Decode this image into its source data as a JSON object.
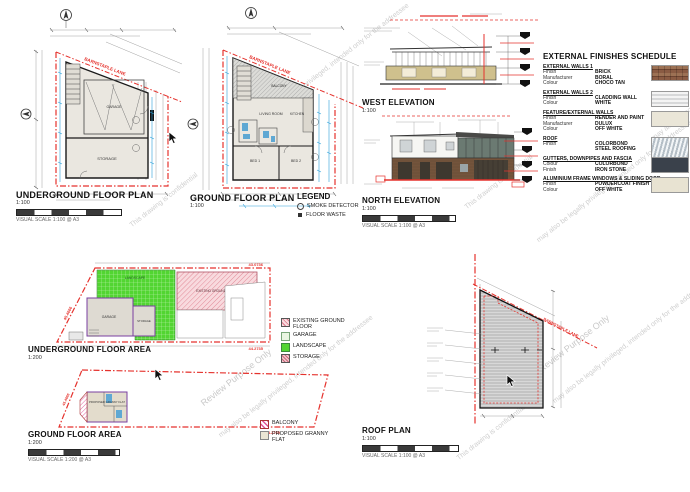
{
  "street_label": "BARNSTAPLE LANE",
  "watermarks": {
    "confidential": "This drawing is confidential",
    "review": "Review Purpose Only",
    "privileged": "may also be legally privileged, intended only for the addressee"
  },
  "plans": {
    "underground_plan": {
      "title": "UNDERGROUND FLOOR PLAN",
      "scale": "1:100",
      "scale_caption": "VISUAL SCALE 1:100 @ A3",
      "rooms": {
        "garage": "GARAGE",
        "storage": "STORAGE"
      }
    },
    "ground_plan": {
      "title": "GROUND FLOOR PLAN",
      "scale": "1:100",
      "rooms": {
        "balcony": "BALCONY",
        "living": "LIVING ROOM",
        "kitchen": "KITCHEN",
        "bed1": "BED 1",
        "bed2": "BED 2"
      }
    },
    "plan_legend": {
      "title": "LEGEND",
      "items": [
        {
          "label": "SMOKE DETECTOR"
        },
        {
          "label": "FLOOR WASTE"
        }
      ]
    },
    "west_elevation": {
      "title": "WEST ELEVATION",
      "scale": "1:100"
    },
    "north_elevation": {
      "title": "NORTH ELEVATION",
      "scale": "1:100",
      "scale_caption": "VISUAL SCALE 1:100 @ A3"
    },
    "underground_area": {
      "title": "UNDERGROUND FLOOR AREA",
      "scale": "1:200",
      "dims": {
        "top": "43.0736",
        "bottom": "44.2735",
        "side": "45.4666"
      },
      "labels": {
        "landscape": "LANDSCAPE",
        "garage": "GARAGE",
        "storage": "STORAGE",
        "existing": "EXISTING GROUND FLOOR"
      }
    },
    "ground_area": {
      "title": "GROUND FLOOR AREA",
      "scale": "1:200",
      "scale_caption": "VISUAL SCALE 1:200 @ A3",
      "dims": {
        "bottom": "44.2735",
        "side": "45.4666"
      },
      "labels": {
        "proposed": "PROPOSED GRANNY FLAT"
      }
    },
    "roof_plan": {
      "title": "ROOF PLAN",
      "scale": "1:100",
      "scale_caption": "VISUAL SCALE 1:100 @ A3"
    }
  },
  "area_legend_1": {
    "items": [
      {
        "label": "EXISTING GROUND FLOOR"
      },
      {
        "label": "GARAGE"
      },
      {
        "label": "LANDSCAPE"
      },
      {
        "label": "STORAGE"
      }
    ]
  },
  "area_legend_2": {
    "items": [
      {
        "label": "BALCONY"
      },
      {
        "label": "PROPOSED GRANNY FLAT"
      }
    ]
  },
  "schedule": {
    "title": "EXTERNAL FINISHES SCHEDULE",
    "items": [
      {
        "section": "EXTERNAL WALLS 1",
        "fields": [
          {
            "label": "Finish",
            "value": "BRICK"
          },
          {
            "label": "Manufacturer",
            "value": "BORAL"
          },
          {
            "label": "Colour",
            "value": "CHOCO TAN"
          }
        ]
      },
      {
        "section": "EXTERNAL WALLS 2",
        "fields": [
          {
            "label": "Finish",
            "value": "CLADDING WALL"
          },
          {
            "label": "Colour",
            "value": "WHITE"
          }
        ]
      },
      {
        "section": "FEATURE/EXTERNAL WALLS",
        "fields": [
          {
            "label": "Finish",
            "value": "RENDER AND PAINT"
          },
          {
            "label": "Manufacturer",
            "value": "DULUX"
          },
          {
            "label": "Colour",
            "value": "OFF WHITE"
          }
        ]
      },
      {
        "section": "ROOF",
        "fields": [
          {
            "label": "Finish",
            "value": "COLORBOND STEEL ROOFING"
          }
        ]
      },
      {
        "section": "GUTTERS, DOWNPIPES AND FASCIA",
        "fields": [
          {
            "label": "Colour",
            "value": "COLORBOND"
          },
          {
            "label": "Finish",
            "value": "IRON STONE"
          }
        ]
      },
      {
        "section": "ALUMINIUM FRAME WINDOWS & SLIDING DOOR",
        "fields": [
          {
            "label": "Finish",
            "value": "POWDERCOAT FINISH"
          },
          {
            "label": "Colour",
            "value": "OFF WHITE"
          }
        ]
      }
    ]
  },
  "colors": {
    "boundary_red": "#e5322d",
    "dimension_blue": "#2b9fd8",
    "watermark_gray": "#cfcfcf",
    "landscape_green": "#55d435",
    "existing_pink": "#f2b9c4",
    "purple_outline": "#7a3fa0"
  }
}
